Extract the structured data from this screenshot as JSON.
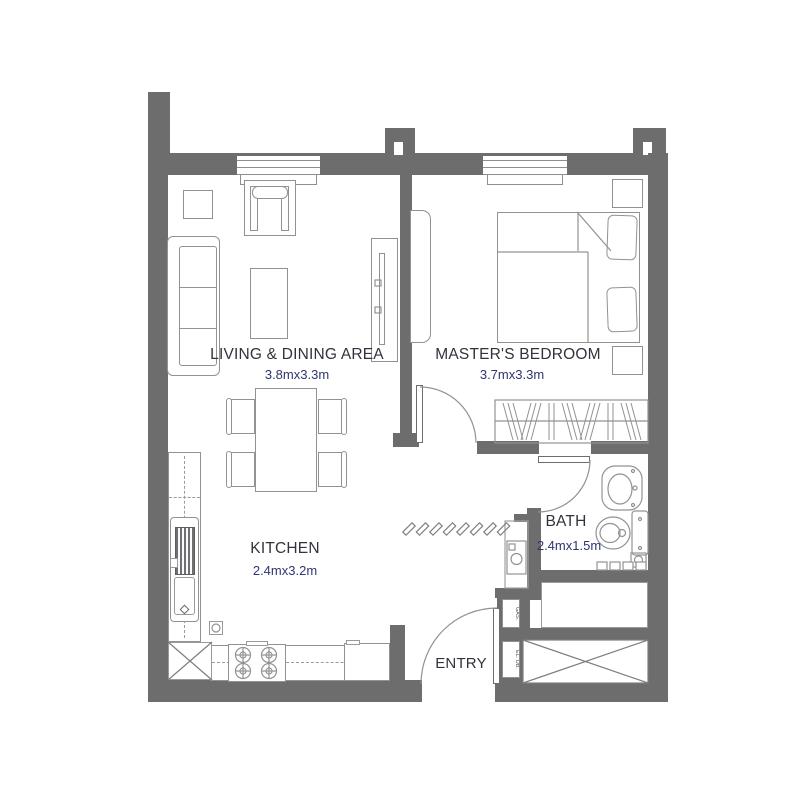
{
  "plan": {
    "title": "One-bedroom apartment floor plan",
    "rooms": [
      {
        "id": "living",
        "name": "LIVING & DINING AREA",
        "dimensions": "3.8mx3.3m"
      },
      {
        "id": "bedroom",
        "name": "MASTER'S BEDROOM",
        "dimensions": "3.7mx3.3m"
      },
      {
        "id": "kitchen",
        "name": "KITCHEN",
        "dimensions": "2.4mx3.2m"
      },
      {
        "id": "bath",
        "name": "BATH",
        "dimensions": "2.4mx1.5m"
      },
      {
        "id": "entry",
        "name": "ENTRY",
        "dimensions": ""
      }
    ],
    "utility_labels": [
      {
        "text": "GAS."
      },
      {
        "text": "EL. DB."
      }
    ],
    "colors": {
      "wall": "#6d6d6d",
      "furniture_line": "#929292",
      "room_name_text": "#30333b",
      "dimension_text": "#2e3570",
      "background": "#ffffff"
    },
    "furniture_icons": [
      "sofa",
      "side-table",
      "armchair",
      "coffee-table",
      "tv-console",
      "dining-table",
      "dining-chair",
      "kitchen-counter",
      "kitchen-sink",
      "stove-burners",
      "fridge",
      "floor-drain",
      "bed",
      "pillow",
      "nightstand",
      "dresser",
      "wardrobe",
      "bath-sink",
      "toilet",
      "washing-machine",
      "shaft",
      "window",
      "door-swing",
      "ceiling-hatch"
    ]
  }
}
